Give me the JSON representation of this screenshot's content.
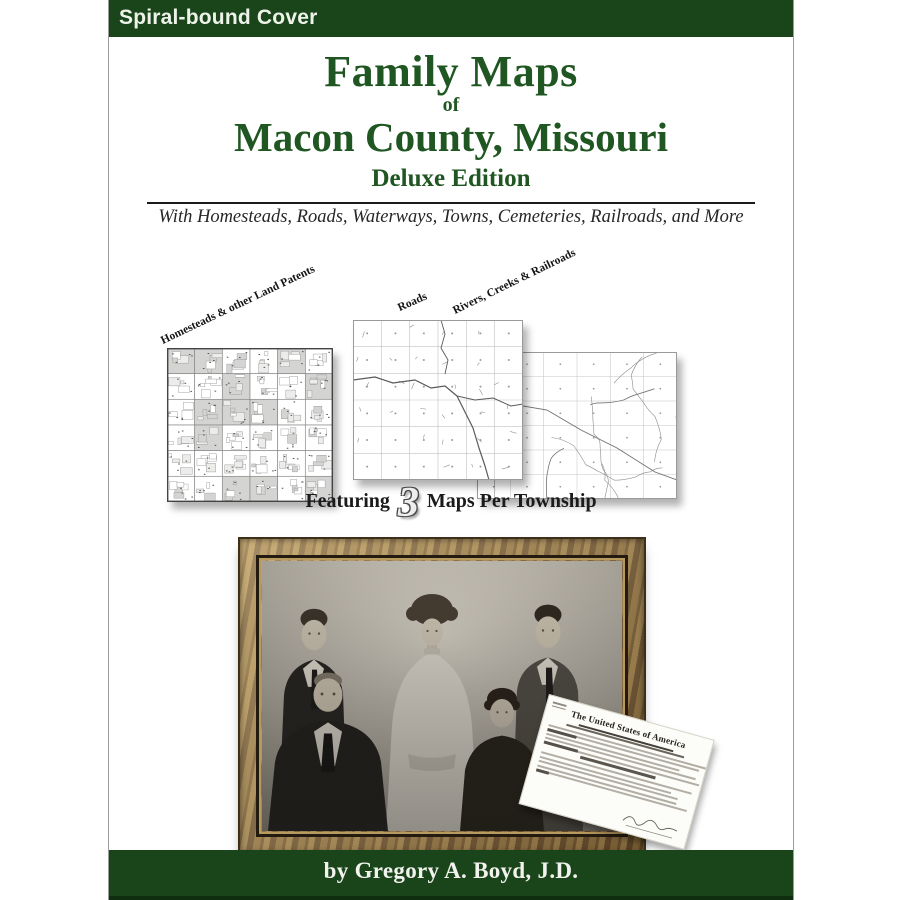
{
  "badge": {
    "label": "Spiral-bound Cover"
  },
  "title": {
    "line1": "Family Maps",
    "connector": "of",
    "line2": "Macon County, Missouri",
    "edition": "Deluxe Edition",
    "tagline": "With Homesteads, Roads, Waterways, Towns, Cemeteries, Railroads, and More"
  },
  "maps": {
    "left_label": "Homesteads & other Land Patents",
    "middle_label": "Roads",
    "right_label": "Rivers, Creeks & Railroads"
  },
  "featuring": {
    "prefix": "Featuring",
    "number": "3",
    "suffix": "Maps Per Township"
  },
  "document": {
    "title": "The United States of America"
  },
  "author": {
    "byline": "by Gregory A. Boyd, J.D."
  },
  "colors": {
    "cover_green": "#1a451a",
    "title_green": "#1f5621",
    "frame_brown": "#8a6b3e",
    "page_white": "#ffffff",
    "shaded_parcel_gray": "#d4d4d2"
  }
}
